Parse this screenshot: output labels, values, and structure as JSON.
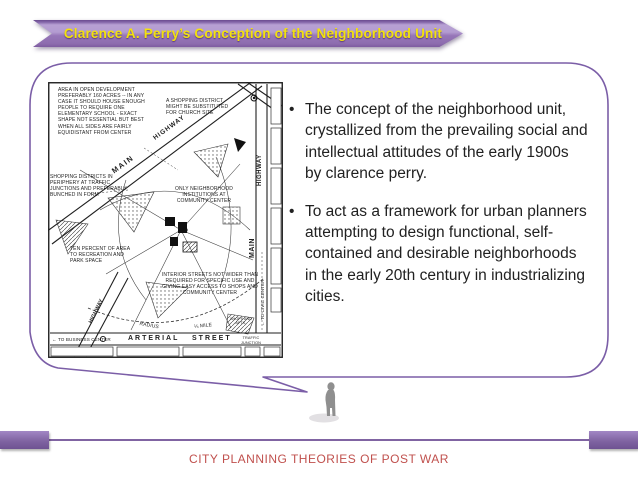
{
  "slide": {
    "title": "Clarence A. Perry’s Conception of the Neighborhood Unit",
    "footer": "CITY PLANNING THEORIES OF POST WAR"
  },
  "speech_bubble": {
    "bullet_glyph": "•",
    "bullets": [
      "The concept of the neighborhood unit, crystallized from the prevailing social and intellectual attitudes of the early 1900s by clarence perry.",
      "To act as a framework for urban planners attempting to design functional, self-contained and desirable neighborhoods in the early 20th century in industrializing cities."
    ]
  },
  "diagram": {
    "labels": {
      "area_note": "AREA IN OPEN DEVELOPMENT PREFERABLY 160 ACRES -- IN ANY CASE IT SHOULD HOUSE ENOUGH PEOPLE TO REQUIRE ONE ELEMENTARY SCHOOL - EXACT SHAPE NOT ESSENTIAL BUT BEST WHEN ALL SIDES ARE FAIRLY EQUIDISTANT FROM CENTER",
      "shopping_substitute": "A SHOPPING DISTRICT MIGHT BE SUBSTITUTED FOR CHURCH SITE",
      "shopping_districts": "SHOPPING DISTRICTS IN PERIPHERY AT TRAFFIC JUNCTIONS AND PREFERABLY BUNCHED IN FORM",
      "only_institutions": "ONLY NEIGHBORHOOD INSTITUTIONS AT COMMUNITY CENTER",
      "ten_percent": "TEN PERCENT OF AREA TO RECREATION AND PARK SPACE",
      "interior_streets": "INTERIOR STREETS NOT WIDER THAN REQUIRED FOR SPECIFIC USE AND GIVING EASY ACCESS TO SHOPS AND COMMUNITY CENTER",
      "main_diagonal": "MAIN",
      "highway_diagonal": "HIGHWAY",
      "highway_right": "HIGHWAY",
      "main_right": "MAIN",
      "to_civic_center": "← TO CIVIC CENTER",
      "highway_bottom_left": "HIGHWAY",
      "to_business_center": "← TO BUSINESS CENTER",
      "arterial": "ARTERIAL",
      "street": "STREET",
      "traffic_junction": "TRAFFIC JUNCTION",
      "radius": "RADIUS",
      "quarter_mile": "¼ MILE",
      "shops_apts": "SHOPS AND APTS."
    }
  },
  "colors": {
    "ribbon_purple": "#9676b8",
    "ribbon_purple_light": "#b7a0d3",
    "ribbon_purple_dark": "#6a4b8f",
    "title_yellow": "#f2e10e",
    "bubble_border": "#7b5ea7",
    "footer_bar_purple": "#8064a2",
    "footer_text_red": "#c0504d",
    "body_text": "#212121",
    "map_ink": "#1f1f1f",
    "person_gray": "#8f8f8f"
  }
}
